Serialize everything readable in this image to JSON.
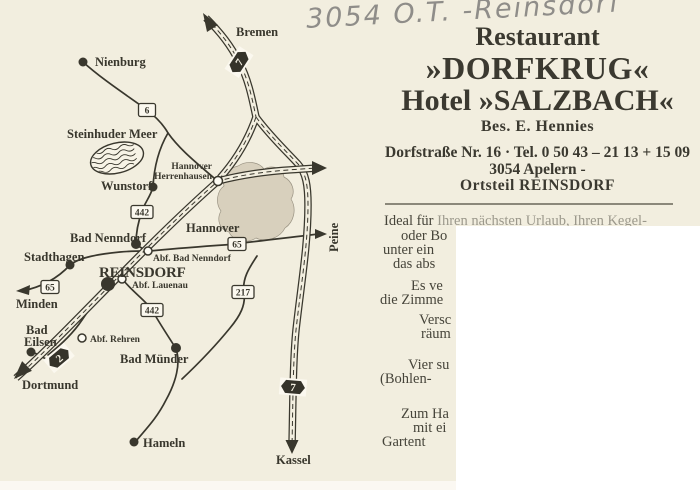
{
  "handwriting": "3054 O.T. -Reinsdorf",
  "header": {
    "line1": "Restaurant",
    "line2": "»DORFKRUG«",
    "line3": "Hotel »SALZBACH«",
    "owner": "Bes. E. Hennies",
    "address_line1": "Dorfstraße Nr. 16 · Tel. 0 50 43 – 21 13 + 15 09",
    "address_line2": "3054 Apelern -",
    "address_line3": "Ortsteil REINSDORF"
  },
  "body": {
    "line1_start": "Ideal für ",
    "line1_rest": "Ihren nächsten Urlaub, Ihren Kegel-",
    "f02": "oder Bo",
    "f03": "unter ein",
    "f04": "das abs",
    "f05": "Es ve",
    "f06": "die Zimme",
    "f07": "Versc",
    "f08": "räum",
    "f09": "Vier su",
    "f10": "(Bohlen-",
    "f11": "Zum Ha",
    "f12": "mit ei",
    "f13": "Gartent"
  },
  "map": {
    "labels": {
      "nienburg": "Nienburg",
      "bremen": "Bremen",
      "steinhuder_meer": "Steinhuder Meer",
      "hannover_herrenhausen_1": "Hannover",
      "hannover_herrenhausen_2": "Herrenhausen",
      "wunstorf": "Wunstorf",
      "hannover": "Hannover",
      "bad_nenndorf": "Bad Nenndorf",
      "abf_bad_nenndorf": "Abf. Bad Nenndorf",
      "stadthagen": "Stadthagen",
      "reinsdorf": "REINSDORF",
      "abf_lauenau": "Abf. Lauenau",
      "minden": "Minden",
      "bad_eilsen_1": "Bad",
      "bad_eilsen_2": "Eilsen",
      "abf_rehren": "Abf. Rehren",
      "dortmund": "Dortmund",
      "bad_muender": "Bad Münder",
      "hameln": "Hameln",
      "kassel": "Kassel",
      "peine": "Peine"
    },
    "route_badges": {
      "b6": "6",
      "b442_north": "442",
      "b65_east": "65",
      "b65_west": "65",
      "b217": "217",
      "b442_south": "442"
    },
    "autobahn_badges": {
      "a7_north": "7",
      "a2": "2",
      "a7_south": "7"
    }
  },
  "colors": {
    "background": "#f2eedf",
    "ink": "#39372d",
    "handwriting": "#8f8d89",
    "city_area_fill": "#d8d0bd",
    "overlay": "#ffffff"
  }
}
